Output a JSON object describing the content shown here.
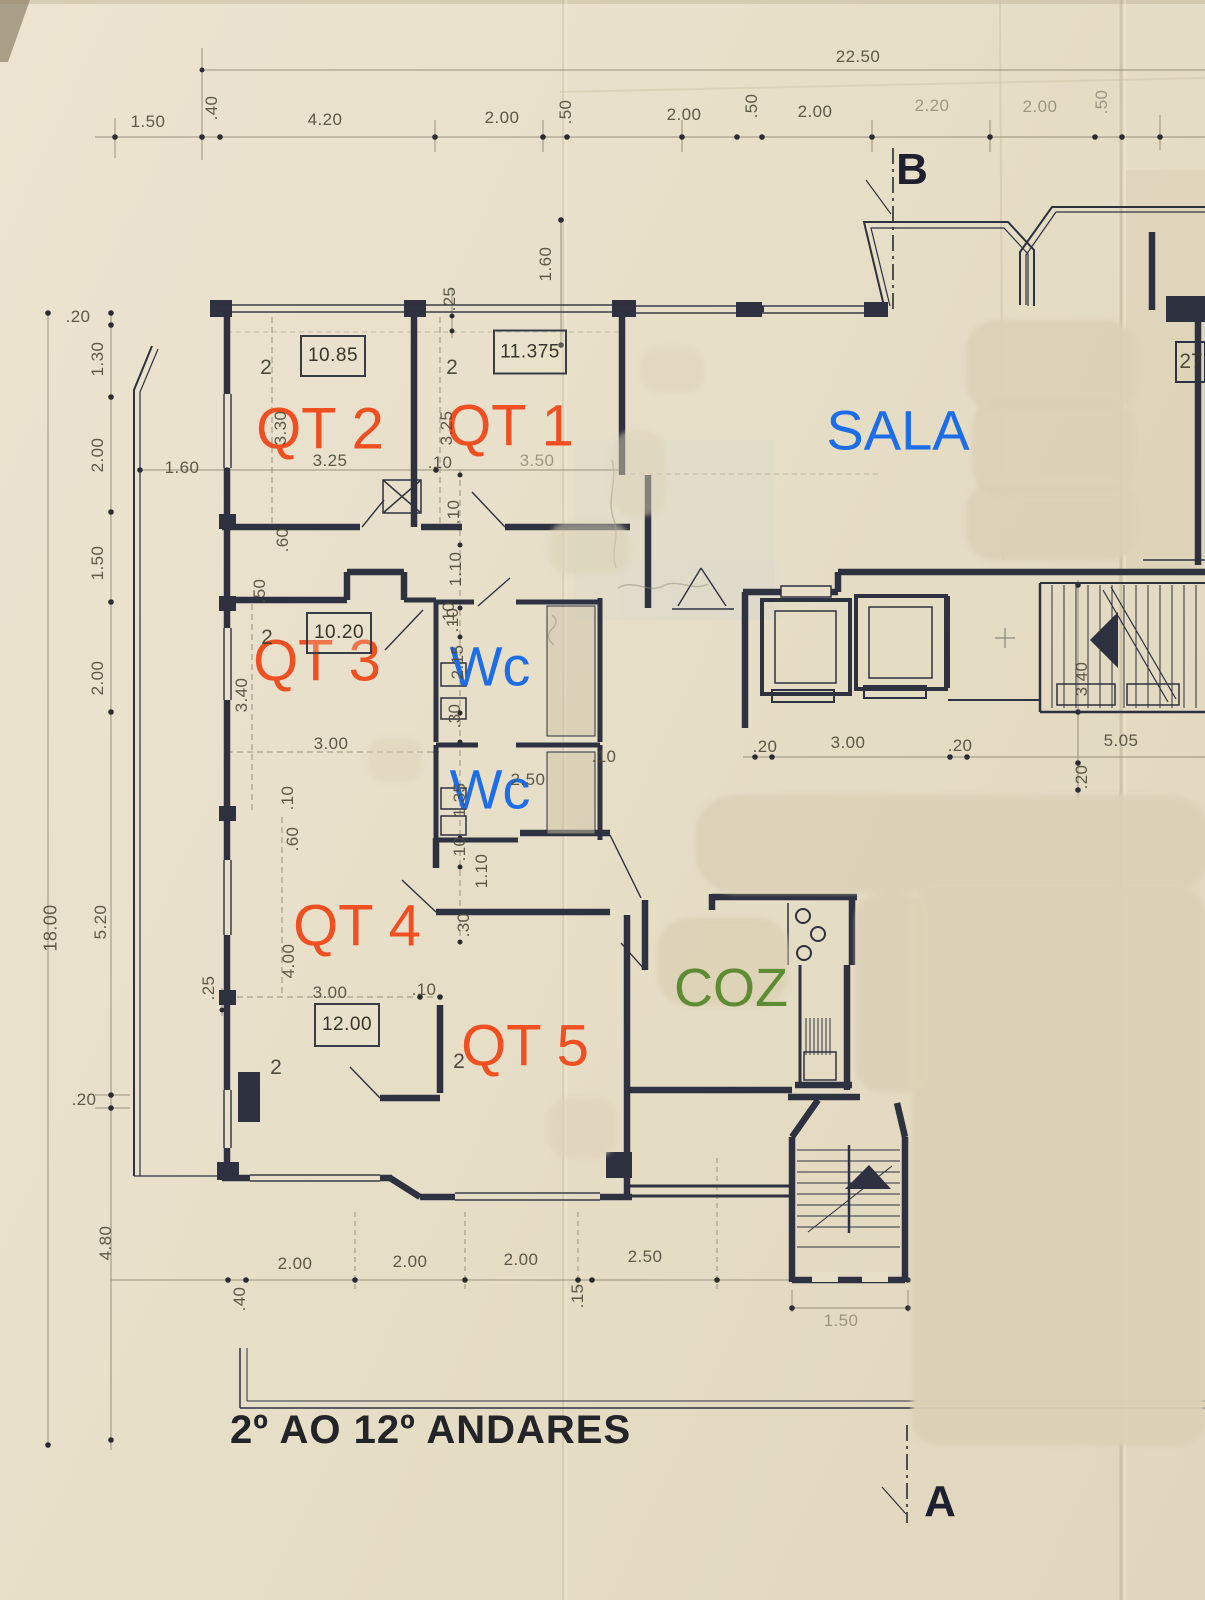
{
  "colors": {
    "paper": "#e7dfc8",
    "ink": "#2e3140",
    "dim_text": "#4f4a3a",
    "qt_orange": "#f04f21",
    "label_blue": "#1d6ce8",
    "coz_green": "#5d8c33",
    "title_black": "#23232a",
    "whiteout_patch": "#dbd1b6"
  },
  "title": {
    "text": "2º AO 12º ANDARES"
  },
  "section_markers": [
    {
      "label": "B",
      "x": 912,
      "y": 170
    },
    {
      "label": "A",
      "x": 940,
      "y": 1502
    }
  ],
  "room_labels": [
    {
      "id": "qt2",
      "text": "QT 2",
      "x": 320,
      "y": 429,
      "color": "#f04f21",
      "size": 58
    },
    {
      "id": "qt1",
      "text": "QT 1",
      "x": 510,
      "y": 426,
      "color": "#f04f21",
      "size": 58
    },
    {
      "id": "sala",
      "text": "SALA",
      "x": 898,
      "y": 430,
      "color": "#1d6ce8",
      "size": 56
    },
    {
      "id": "qt3",
      "text": "QT 3",
      "x": 317,
      "y": 661,
      "color": "#f04f21",
      "size": 58
    },
    {
      "id": "wc-upper",
      "text": "Wc",
      "x": 490,
      "y": 666,
      "color": "#1d6ce8",
      "size": 56
    },
    {
      "id": "wc-lower",
      "text": "Wc",
      "x": 490,
      "y": 789,
      "color": "#1d6ce8",
      "size": 56
    },
    {
      "id": "qt4",
      "text": "QT 4",
      "x": 357,
      "y": 926,
      "color": "#f04f21",
      "size": 58
    },
    {
      "id": "coz",
      "text": "COZ",
      "x": 731,
      "y": 988,
      "color": "#5d8c33",
      "size": 54
    },
    {
      "id": "qt5",
      "text": "QT 5",
      "x": 525,
      "y": 1046,
      "color": "#f04f21",
      "size": 58
    }
  ],
  "area_boxes": [
    {
      "value": "10.85",
      "x": 333,
      "y": 356,
      "w": 62,
      "h": 38
    },
    {
      "value": "11.375",
      "x": 530,
      "y": 352,
      "w": 70,
      "h": 41
    },
    {
      "value": "10.20",
      "x": 339,
      "y": 633,
      "w": 62,
      "h": 38
    },
    {
      "value": "12.00",
      "x": 347,
      "y": 1025,
      "w": 62,
      "h": 40
    }
  ],
  "room_numbers": [
    {
      "value": "2",
      "x": 266,
      "y": 368
    },
    {
      "value": "2",
      "x": 452,
      "y": 368
    },
    {
      "value": "2",
      "x": 267,
      "y": 638
    },
    {
      "value": "2",
      "x": 276,
      "y": 1068
    },
    {
      "value": "2",
      "x": 459,
      "y": 1062
    },
    {
      "value": "27",
      "x": 1191,
      "y": 362
    }
  ],
  "dim_labels": [
    {
      "t": "22.50",
      "x": 858,
      "y": 57
    },
    {
      "t": "1.50",
      "x": 148,
      "y": 122
    },
    {
      "t": ".40",
      "x": 212,
      "y": 108,
      "r": 1
    },
    {
      "t": "4.20",
      "x": 325,
      "y": 120
    },
    {
      "t": "2.00",
      "x": 502,
      "y": 118
    },
    {
      "t": ".50",
      "x": 566,
      "y": 112,
      "r": 1
    },
    {
      "t": "2.00",
      "x": 684,
      "y": 115
    },
    {
      "t": ".50",
      "x": 752,
      "y": 106,
      "r": 1
    },
    {
      "t": "2.00",
      "x": 815,
      "y": 112
    },
    {
      "t": "2.20",
      "x": 932,
      "y": 106,
      "f": 1
    },
    {
      "t": "2.00",
      "x": 1040,
      "y": 107,
      "f": 1
    },
    {
      "t": ".50",
      "x": 1102,
      "y": 102,
      "r": 1,
      "f": 1
    },
    {
      "t": ".20",
      "x": 78,
      "y": 317
    },
    {
      "t": "1.30",
      "x": 98,
      "y": 359,
      "r": 1
    },
    {
      "t": "2.00",
      "x": 98,
      "y": 455,
      "r": 1
    },
    {
      "t": "1.60",
      "x": 182,
      "y": 468
    },
    {
      "t": "1.50",
      "x": 98,
      "y": 563,
      "r": 1
    },
    {
      "t": "2.00",
      "x": 98,
      "y": 678,
      "r": 1
    },
    {
      "t": "18.00",
      "x": 51,
      "y": 928,
      "r": 1,
      "s": 18
    },
    {
      "t": "5.20",
      "x": 101,
      "y": 922,
      "r": 1
    },
    {
      "t": ".20",
      "x": 84,
      "y": 1100
    },
    {
      "t": "4.80",
      "x": 106,
      "y": 1243,
      "r": 1
    },
    {
      "t": ".25",
      "x": 209,
      "y": 988,
      "r": 1
    },
    {
      "t": ".25",
      "x": 450,
      "y": 299,
      "r": 1
    },
    {
      "t": "1.60",
      "x": 546,
      "y": 264,
      "r": 1
    },
    {
      "t": "3.30",
      "x": 281,
      "y": 428,
      "r": 1
    },
    {
      "t": "3.25",
      "x": 330,
      "y": 461
    },
    {
      "t": "3.25",
      "x": 447,
      "y": 428,
      "r": 1
    },
    {
      "t": ".10",
      "x": 440,
      "y": 463
    },
    {
      "t": "3.50",
      "x": 537,
      "y": 461,
      "f": 1
    },
    {
      "t": ".60",
      "x": 283,
      "y": 540,
      "r": 1
    },
    {
      "t": ".50",
      "x": 260,
      "y": 591,
      "r": 1
    },
    {
      "t": "3.40",
      "x": 242,
      "y": 695,
      "r": 1
    },
    {
      "t": "3.00",
      "x": 331,
      "y": 744
    },
    {
      "t": ".10",
      "x": 449,
      "y": 614,
      "r": 1
    },
    {
      "t": "2.15",
      "x": 458,
      "y": 662,
      "r": 1
    },
    {
      "t": ".30",
      "x": 455,
      "y": 716,
      "r": 1
    },
    {
      "t": ".10",
      "x": 454,
      "y": 512,
      "r": 1
    },
    {
      "t": "1.10",
      "x": 456,
      "y": 569,
      "r": 1
    },
    {
      "t": ".10",
      "x": 453,
      "y": 620,
      "r": 1
    },
    {
      "t": ".10",
      "x": 604,
      "y": 757
    },
    {
      "t": "1.35",
      "x": 460,
      "y": 800,
      "r": 1
    },
    {
      "t": "2.50",
      "x": 528,
      "y": 780
    },
    {
      "t": ".10",
      "x": 288,
      "y": 798,
      "r": 1
    },
    {
      "t": ".60",
      "x": 293,
      "y": 839,
      "r": 1
    },
    {
      "t": ".10",
      "x": 460,
      "y": 849,
      "r": 1
    },
    {
      "t": "1.10",
      "x": 482,
      "y": 871,
      "r": 1
    },
    {
      "t": ".30",
      "x": 464,
      "y": 925,
      "r": 1
    },
    {
      "t": "4.00",
      "x": 289,
      "y": 961,
      "r": 1
    },
    {
      "t": "3.00",
      "x": 330,
      "y": 993
    },
    {
      "t": ".10",
      "x": 424,
      "y": 990
    },
    {
      "t": ".20",
      "x": 765,
      "y": 747
    },
    {
      "t": "3.00",
      "x": 848,
      "y": 743
    },
    {
      "t": ".20",
      "x": 960,
      "y": 746
    },
    {
      "t": "5.05",
      "x": 1121,
      "y": 741
    },
    {
      "t": "3.40",
      "x": 1082,
      "y": 679,
      "r": 1
    },
    {
      "t": ".20",
      "x": 1082,
      "y": 777,
      "r": 1
    },
    {
      "t": "2.00",
      "x": 295,
      "y": 1264
    },
    {
      "t": "2.00",
      "x": 410,
      "y": 1262
    },
    {
      "t": "2.00",
      "x": 521,
      "y": 1260
    },
    {
      "t": "2.50",
      "x": 645,
      "y": 1257
    },
    {
      "t": ".40",
      "x": 240,
      "y": 1299,
      "r": 1
    },
    {
      "t": ".15",
      "x": 578,
      "y": 1296,
      "r": 1
    },
    {
      "t": "1.50",
      "x": 841,
      "y": 1321,
      "f": 1
    }
  ]
}
